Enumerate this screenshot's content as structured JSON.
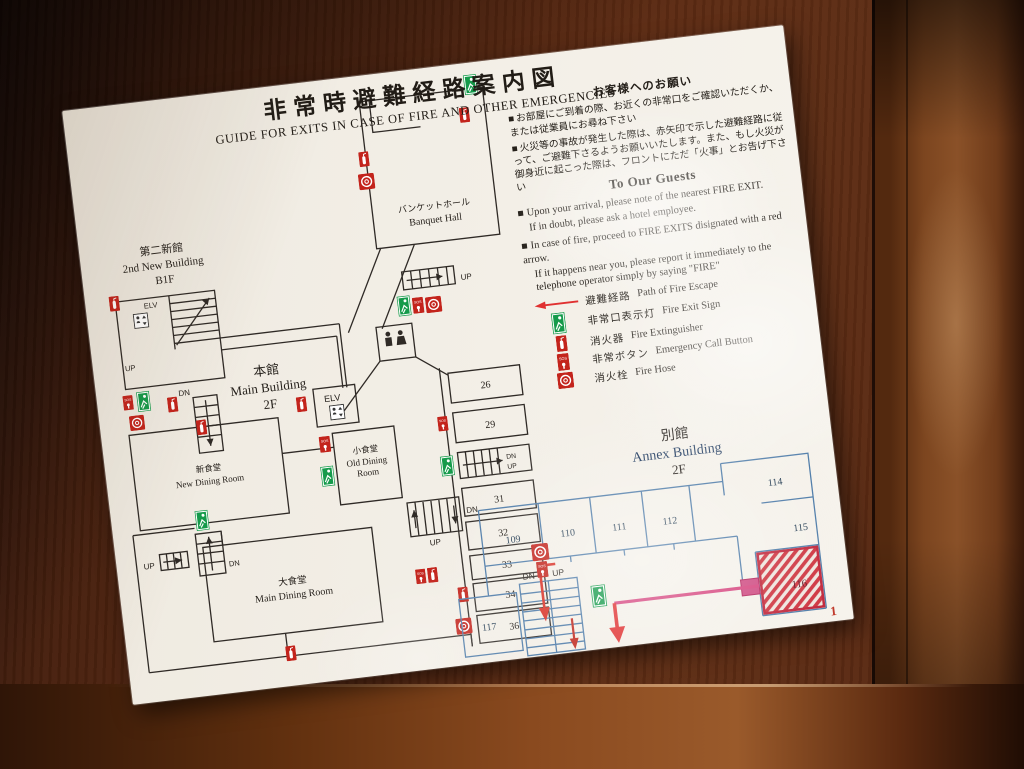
{
  "title": {
    "ja": "非常時避難経路案内図",
    "en": "GUIDE FOR EXITS IN CASE OF FIRE AND OTHER EMERGENCIES"
  },
  "notice_ja": {
    "heading": "お客様へのお願い",
    "item1": "お部屋にご到着の際、お近くの非常口をご確認いただくか、または従業員にお尋ね下さい",
    "item2": "火災等の事故が発生した際は、赤矢印で示した避難経路に従って、ご避難下さるようお願いいたします。また、もし火災が御身近に起こった際は、フロントにただ「火事」とお告げ下さい"
  },
  "notice_en": {
    "heading": "To Our Guests",
    "item1_main": "Upon your arrival, please note of the nearest FIRE EXIT.",
    "item1_sub": "If in doubt, please ask a hotel employee.",
    "item2_main": "In case of fire, proceed to FIRE EXITS disignated with a red arrow.",
    "item2_sub": "If it happens near you, please report it immediately to the telephone operator simply by saying \"FIRE\""
  },
  "legend": {
    "rows": [
      {
        "icon": "escape-route-arrow",
        "ja": "避難経路",
        "en": "Path of Fire Escape"
      },
      {
        "icon": "fire-exit-sign",
        "ja": "非常口表示灯",
        "en": "Fire  Exit  Sign"
      },
      {
        "icon": "fire-extinguisher",
        "ja": "消火器",
        "en": "Fire Extinguisher"
      },
      {
        "icon": "emergency-call-button",
        "ja": "非常ボタン",
        "en": "Emergency Call Button"
      },
      {
        "icon": "fire-hose",
        "ja": "消火栓",
        "en": "Fire Hose"
      }
    ]
  },
  "buildings": {
    "second_new": {
      "ja": "第二新館",
      "en": "2nd New Building",
      "floor": "B1F"
    },
    "main": {
      "ja": "本館",
      "en": "Main Building",
      "floor": "2F"
    },
    "annex": {
      "ja": "別館",
      "en": "Annex Building",
      "floor": "2F"
    }
  },
  "rooms": {
    "banquet": {
      "ja": "バンケットホール",
      "en": "Banquet Hall"
    },
    "new_dining": {
      "ja": "新食堂",
      "en": "New Dining Room"
    },
    "old_dining": {
      "ja": "小食堂",
      "en1": "Old Dining",
      "en2": "Room"
    },
    "main_dining": {
      "ja": "大食堂",
      "en": "Main Dining Room"
    },
    "main": [
      "26",
      "29",
      "31",
      "32",
      "33",
      "34",
      "36"
    ],
    "annex": [
      "109",
      "110",
      "111",
      "112",
      "114",
      "115",
      "116",
      "117"
    ]
  },
  "misc": {
    "up": "UP",
    "dn": "DN",
    "elv": "ELV",
    "sos": "SOS",
    "bullet": "■"
  },
  "page_mark": "1",
  "colors": {
    "poster": "#f3efe7",
    "wood": "#5c2a12",
    "plan_line": "#2f2a26",
    "annex_line": "#4f7ca9",
    "red": "#c3241c",
    "green": "#159a4a",
    "escape_pink": "#d6447e",
    "arrow_red": "#e03131"
  }
}
